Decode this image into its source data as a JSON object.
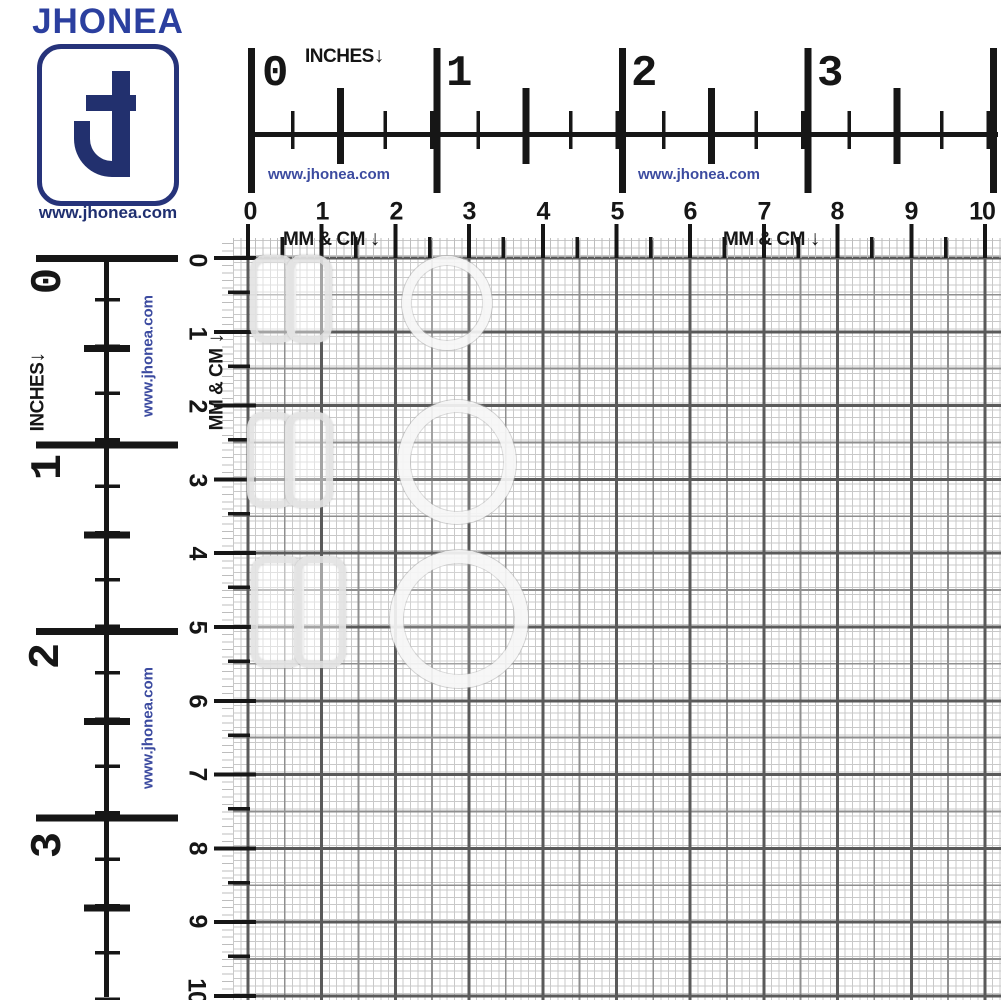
{
  "logo": {
    "brand": "JHONEA",
    "monogram": "J",
    "website": "www.jhonea.com"
  },
  "colors": {
    "brand_blue": "#2b3f9f",
    "navy": "#22306e",
    "website_blue": "#3c4ba0",
    "ruler_ink": "#161616",
    "grid_fine": "#c9c9c9",
    "grid_medium": "#8f8f8f",
    "grid_heavy": "#5a5a5a"
  },
  "top_ruler": {
    "unit_label": "INCHES",
    "unit_arrow": "↓",
    "inch_numbers": [
      "0",
      "1",
      "2",
      "3"
    ],
    "website": "www.jhonea.com",
    "website2": "www.jhonea.com",
    "mmcm_label": "MM & CM",
    "mmcm_label2": "MM & CM",
    "mmcm_arrow": "↓",
    "cm_numbers": [
      "0",
      "1",
      "2",
      "3",
      "4",
      "5",
      "6",
      "7",
      "8",
      "9",
      "10"
    ]
  },
  "left_ruler": {
    "unit_label": "INCHES",
    "unit_arrow": "↓",
    "inch_numbers": [
      "0",
      "1",
      "2",
      "3"
    ],
    "website": "www.jhonea.com",
    "website2": "www.jhonea.com",
    "mmcm_label": "MM & CM",
    "mmcm_arrow": "↓",
    "cm_numbers": [
      "0",
      "1",
      "2",
      "3",
      "4",
      "5",
      "6",
      "7",
      "8",
      "9",
      "10"
    ]
  },
  "products": {
    "description": "transparent bra strap adjusters photographed on mm grid",
    "rows": [
      {
        "left": "clear-slider-small",
        "right": "clear-ring-small"
      },
      {
        "left": "clear-slider-medium",
        "right": "clear-ring-medium"
      },
      {
        "left": "clear-slider-large",
        "right": "clear-ring-large"
      }
    ]
  }
}
